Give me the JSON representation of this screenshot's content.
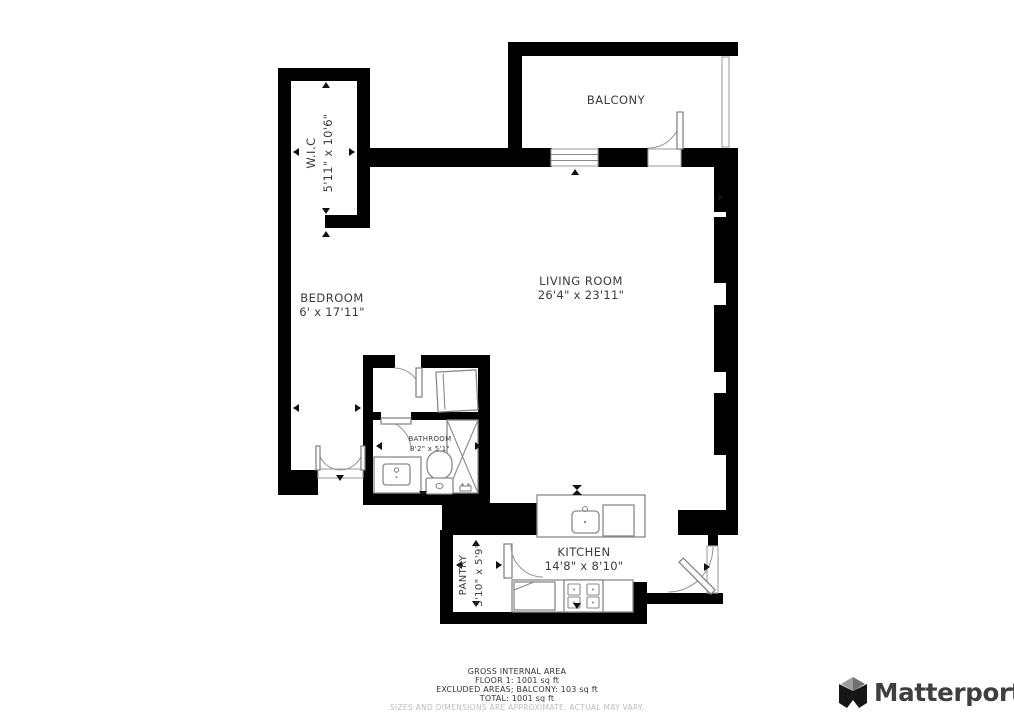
{
  "rooms": {
    "wic": {
      "name": "W.I.C",
      "dims": "5'11\" x 10'6\""
    },
    "balcony": {
      "name": "BALCONY"
    },
    "bedroom": {
      "name": "BEDROOM",
      "dims": "6' x 17'11\""
    },
    "living": {
      "name": "LIVING ROOM",
      "dims": "26'4\" x 23'11\""
    },
    "bathroom": {
      "name": "BATHROOM",
      "dims": "8'2\" x 5'1\""
    },
    "pantry": {
      "name": "PANTRY",
      "dims": "3'10\" x 5'9\""
    },
    "kitchen": {
      "name": "KITCHEN",
      "dims": "14'8\" x 8'10\""
    }
  },
  "footer": {
    "area_heading": "GROSS INTERNAL AREA",
    "floor_line": "FLOOR 1: 1001 sq ft",
    "excluded_line": "EXCLUDED AREAS; BALCONY: 103 sq ft",
    "total_line": "TOTAL: 1001 sq ft",
    "disclaimer": "SIZES AND DIMENSIONS ARE APPROXIMATE, ACTUAL MAY VARY."
  },
  "branding": {
    "logo_text": "Matterport"
  },
  "colors": {
    "wall": "#000000",
    "label": "#3b3b3b",
    "fixture_stroke": "#8a8a8a",
    "disclaimer": "#bdbdbd",
    "logo": "#3f3f3f"
  }
}
